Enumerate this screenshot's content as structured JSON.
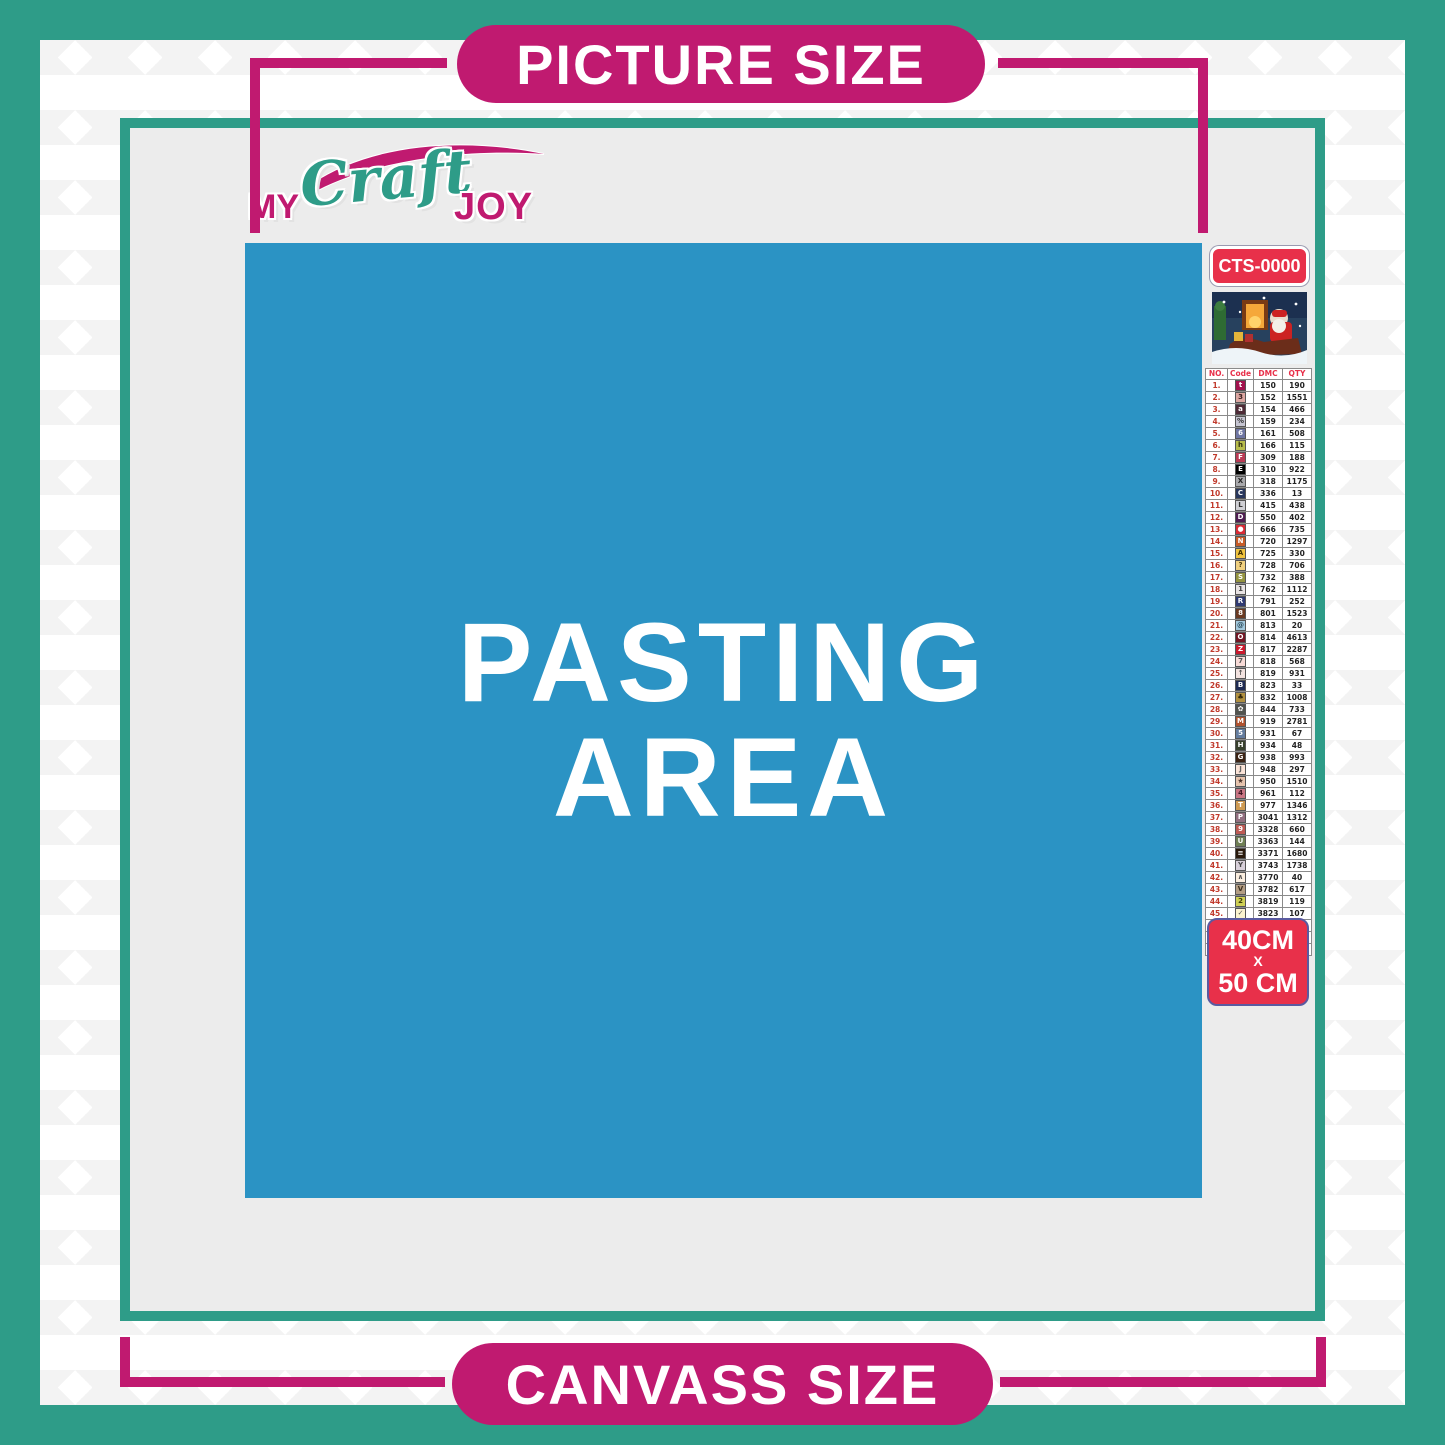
{
  "banners": {
    "top": "PICTURE SIZE",
    "bottom": "CANVASS SIZE"
  },
  "logo": {
    "word1": "MY",
    "word2": "Craft",
    "word3": "JOY"
  },
  "pasting_area": {
    "line1": "PASTING",
    "line2": "AREA"
  },
  "kit": {
    "sku": "CTS-0000",
    "size_line1": "40CM",
    "size_line2": "X",
    "size_line3": "50 CM"
  },
  "colors": {
    "teal": "#2E9C88",
    "magenta": "#C01A70",
    "blue_pasting": "#2B93C4",
    "red_label": "#E8304A",
    "canvas_gray": "#ECECEC"
  },
  "color_chart": {
    "headers": [
      "NO.",
      "Code",
      "DMC",
      "QTY"
    ],
    "row_format": [
      "no",
      "symbol",
      "symbol_bg",
      "symbol_fg",
      "dmc",
      "qty"
    ],
    "rows": [
      [
        "1.",
        "t",
        "#A3124E",
        "#ffffff",
        "150",
        "190"
      ],
      [
        "2.",
        "3",
        "#DCA6A1",
        "#3a2020",
        "152",
        "1551"
      ],
      [
        "3.",
        "a",
        "#4E2A36",
        "#ffffff",
        "154",
        "466"
      ],
      [
        "4.",
        "%",
        "#C6C5D2",
        "#333333",
        "159",
        "234"
      ],
      [
        "5.",
        "6",
        "#6F76A3",
        "#ffffff",
        "161",
        "508"
      ],
      [
        "6.",
        "h",
        "#B7BC4B",
        "#333311",
        "166",
        "115"
      ],
      [
        "7.",
        "F",
        "#BA3A55",
        "#ffffff",
        "309",
        "188"
      ],
      [
        "8.",
        "E",
        "#000000",
        "#ffffff",
        "310",
        "922"
      ],
      [
        "9.",
        "X",
        "#A9A9AC",
        "#222222",
        "318",
        "1175"
      ],
      [
        "10.",
        "C",
        "#28365C",
        "#ffffff",
        "336",
        "13"
      ],
      [
        "11.",
        "L",
        "#CFCFD4",
        "#333333",
        "415",
        "438"
      ],
      [
        "12.",
        "D",
        "#4F1C51",
        "#ffffff",
        "550",
        "402"
      ],
      [
        "13.",
        "●",
        "#D92B35",
        "#ffffff",
        "666",
        "735"
      ],
      [
        "14.",
        "N",
        "#C75B26",
        "#ffffff",
        "720",
        "1297"
      ],
      [
        "15.",
        "A",
        "#F0C23E",
        "#403000",
        "725",
        "330"
      ],
      [
        "16.",
        "?",
        "#F0D080",
        "#4a3a10",
        "728",
        "706"
      ],
      [
        "17.",
        "S",
        "#94943F",
        "#ffffff",
        "732",
        "388"
      ],
      [
        "18.",
        "1",
        "#E9E4E4",
        "#444444",
        "762",
        "1112"
      ],
      [
        "19.",
        "R",
        "#2F3A72",
        "#ffffff",
        "791",
        "252"
      ],
      [
        "20.",
        "8",
        "#6A3A22",
        "#ffffff",
        "801",
        "1523"
      ],
      [
        "21.",
        "@",
        "#A3C8DC",
        "#2a4a5a",
        "813",
        "20"
      ],
      [
        "22.",
        "O",
        "#731624",
        "#ffffff",
        "814",
        "4613"
      ],
      [
        "23.",
        "Z",
        "#CB1A2E",
        "#ffffff",
        "817",
        "2287"
      ],
      [
        "24.",
        "7",
        "#F8DBD7",
        "#555555",
        "818",
        "568"
      ],
      [
        "25.",
        "↑",
        "#F3E3E0",
        "#555555",
        "819",
        "931"
      ],
      [
        "26.",
        "B",
        "#1E2A52",
        "#ffffff",
        "823",
        "33"
      ],
      [
        "27.",
        "♣",
        "#B08F3F",
        "#2e2408",
        "832",
        "1008"
      ],
      [
        "28.",
        "✿",
        "#51534E",
        "#ffffff",
        "844",
        "733"
      ],
      [
        "29.",
        "M",
        "#B0522E",
        "#ffffff",
        "919",
        "2781"
      ],
      [
        "30.",
        "5",
        "#647C9E",
        "#ffffff",
        "931",
        "67"
      ],
      [
        "31.",
        "H",
        "#37402C",
        "#ffffff",
        "934",
        "48"
      ],
      [
        "32.",
        "G",
        "#3C2314",
        "#ffffff",
        "938",
        "993"
      ],
      [
        "33.",
        "J",
        "#FBE4D8",
        "#666666",
        "948",
        "297"
      ],
      [
        "34.",
        "★",
        "#E7C4AE",
        "#4a332a",
        "950",
        "1510"
      ],
      [
        "35.",
        "4",
        "#C97583",
        "#3c1320",
        "961",
        "112"
      ],
      [
        "36.",
        "T",
        "#CE9A52",
        "#ffffff",
        "977",
        "1346"
      ],
      [
        "37.",
        "P",
        "#926F80",
        "#ffffff",
        "3041",
        "1312"
      ],
      [
        "38.",
        "9",
        "#BD5A54",
        "#ffffff",
        "3328",
        "660"
      ],
      [
        "39.",
        "U",
        "#6F7F54",
        "#ffffff",
        "3363",
        "144"
      ],
      [
        "40.",
        "≡",
        "#2A1A0C",
        "#ffffff",
        "3371",
        "1680"
      ],
      [
        "41.",
        "Y",
        "#D8D0DA",
        "#444444",
        "3743",
        "1738"
      ],
      [
        "42.",
        "∧",
        "#FBEEDF",
        "#555555",
        "3770",
        "40"
      ],
      [
        "43.",
        "V",
        "#B39D84",
        "#3a2d1d",
        "3782",
        "617"
      ],
      [
        "44.",
        "2",
        "#CFD054",
        "#3c3c08",
        "3819",
        "119"
      ],
      [
        "45.",
        "✓",
        "#FBF3CF",
        "#555555",
        "3823",
        "107"
      ],
      [
        "46.",
        "C",
        "#E89A4F",
        "#6b3b07",
        "3853",
        "1332"
      ],
      [
        "47.",
        "K",
        "#7D4038",
        "#ffffff",
        "3858",
        "2311"
      ],
      [
        "48.",
        "A",
        "#9A7E62",
        "#ffffff",
        "3863",
        "1820"
      ]
    ]
  }
}
